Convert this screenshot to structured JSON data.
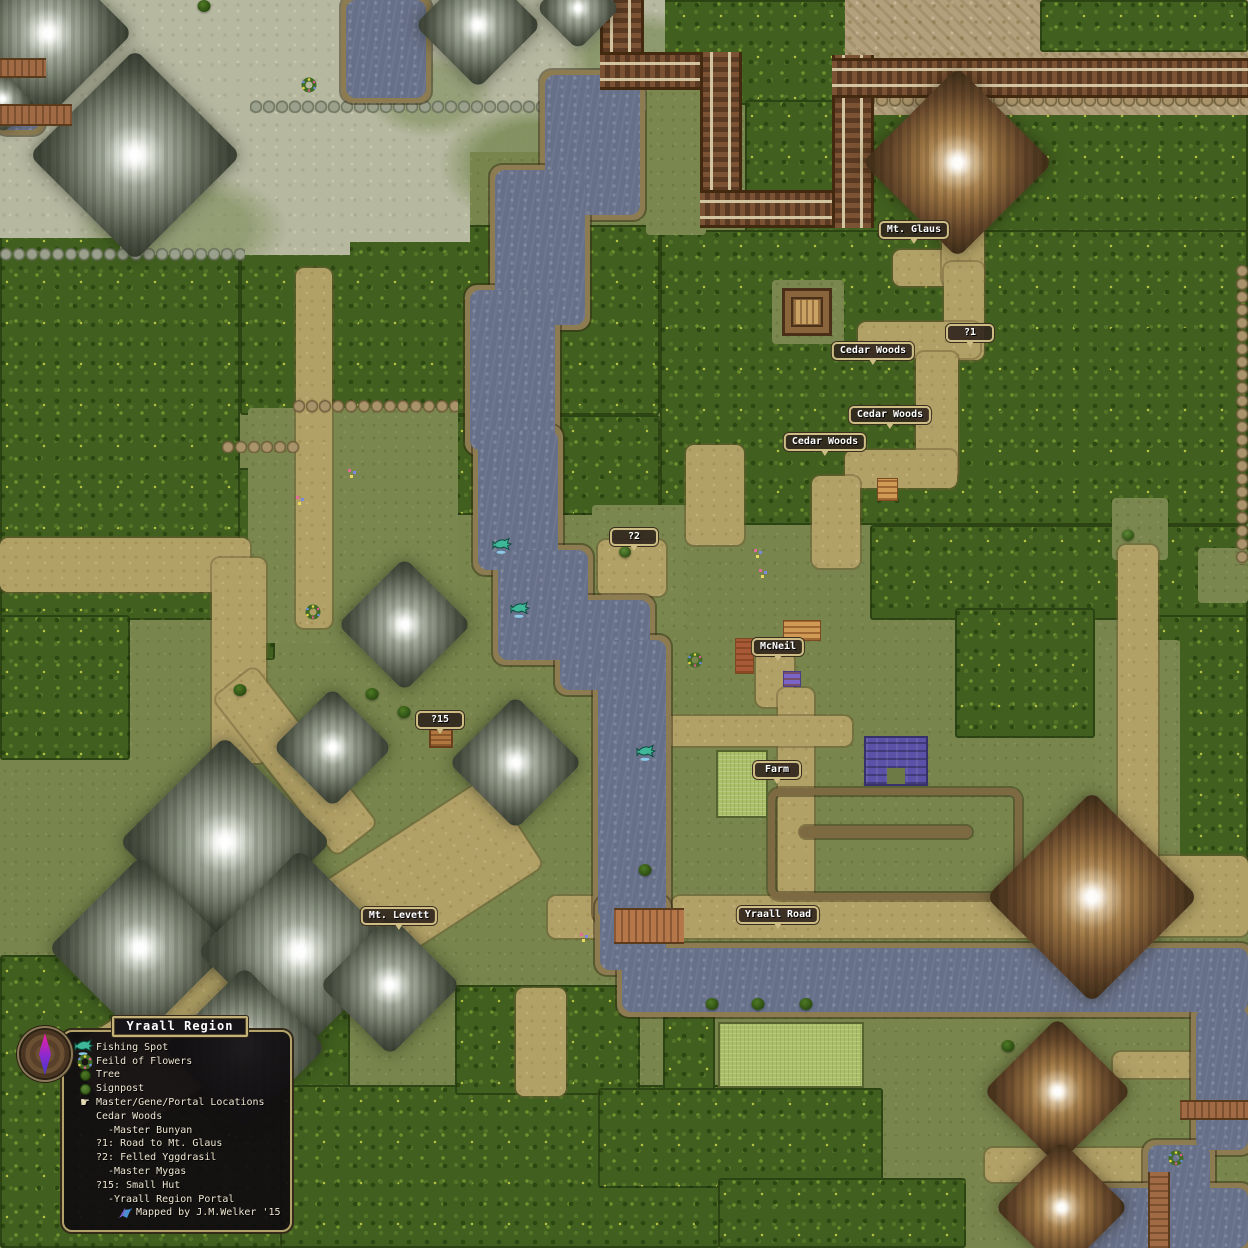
{
  "map": {
    "region_name": "Yraall Region",
    "labels": [
      {
        "text": "Mt. Glaus",
        "x": 914,
        "y": 230
      },
      {
        "text": "?1",
        "x": 970,
        "y": 333
      },
      {
        "text": "Cedar Woods",
        "x": 873,
        "y": 351
      },
      {
        "text": "Cedar Woods",
        "x": 890,
        "y": 415
      },
      {
        "text": "Cedar Woods",
        "x": 825,
        "y": 442
      },
      {
        "text": "?2",
        "x": 634,
        "y": 537
      },
      {
        "text": "McNeil",
        "x": 778,
        "y": 647
      },
      {
        "text": "?15",
        "x": 440,
        "y": 720
      },
      {
        "text": "Farm",
        "x": 777,
        "y": 770
      },
      {
        "text": "Mt. Levett",
        "x": 399,
        "y": 916
      },
      {
        "text": "Yraall Road",
        "x": 778,
        "y": 915
      }
    ],
    "legend": {
      "title": "Yraall Region",
      "items": [
        {
          "icon": "fishing-spot",
          "label": "Fishing Spot"
        },
        {
          "icon": "field-of-flowers",
          "label": "Feild of Flowers"
        },
        {
          "icon": "tree",
          "label": "Tree"
        },
        {
          "icon": "signpost",
          "label": "Signpost"
        },
        {
          "icon": "pointing-hand",
          "label": "Master/Gene/Portal Locations"
        },
        {
          "indent": 1,
          "label": "Cedar Woods"
        },
        {
          "indent": 2,
          "label": "-Master Bunyan"
        },
        {
          "indent": 1,
          "label": "?1: Road to Mt. Glaus"
        },
        {
          "indent": 1,
          "label": "?2: Felled Yggdrasil"
        },
        {
          "indent": 2,
          "label": "-Master Mygas"
        },
        {
          "indent": 1,
          "label": "?15: Small Hut"
        },
        {
          "indent": 2,
          "label": "-Yraall Region Portal"
        },
        {
          "icon": "bird",
          "credit": true,
          "label": "Mapped by J.M.Welker '15"
        }
      ]
    },
    "markers": {
      "fishing_spots": [
        {
          "x": 503,
          "y": 548
        },
        {
          "x": 521,
          "y": 612
        },
        {
          "x": 647,
          "y": 755
        }
      ],
      "flower_fields": [
        {
          "x": 309,
          "y": 87
        },
        {
          "x": 313,
          "y": 614
        },
        {
          "x": 695,
          "y": 662
        },
        {
          "x": 1176,
          "y": 1160
        }
      ],
      "trees": [
        {
          "x": 204,
          "y": 6
        },
        {
          "x": 240,
          "y": 690
        },
        {
          "x": 372,
          "y": 694
        },
        {
          "x": 404,
          "y": 712
        },
        {
          "x": 645,
          "y": 870
        },
        {
          "x": 712,
          "y": 1004
        },
        {
          "x": 758,
          "y": 1004
        },
        {
          "x": 806,
          "y": 1004
        },
        {
          "x": 1008,
          "y": 1046
        }
      ],
      "signposts": [
        {
          "x": 625,
          "y": 552
        },
        {
          "x": 1128,
          "y": 535
        }
      ],
      "flower_specks": [
        {
          "x": 754,
          "y": 549
        },
        {
          "x": 759,
          "y": 569
        },
        {
          "x": 296,
          "y": 496
        },
        {
          "x": 348,
          "y": 469
        },
        {
          "x": 580,
          "y": 933
        }
      ]
    },
    "colors": {
      "grass": "#78854c",
      "forest": "#41601f",
      "water": "#667089",
      "path": "#b2a166",
      "cliff": "#7d6a42",
      "pale_rock": "#b6b8a0",
      "mountain_gray": "#aab1a2",
      "mountain_brown": "#9a7342",
      "track_brown": "#6b4429",
      "farm_field": "#abbf69",
      "tilled_field": "#d09a55",
      "building_purple": "#5b51a6",
      "label_bg": "#322a1e",
      "label_border": "#cdbc84",
      "panel_bg": "#100d10",
      "panel_border": "#b3a26a",
      "needle_top": "#f020a0",
      "needle_bottom": "#4038c8"
    }
  }
}
